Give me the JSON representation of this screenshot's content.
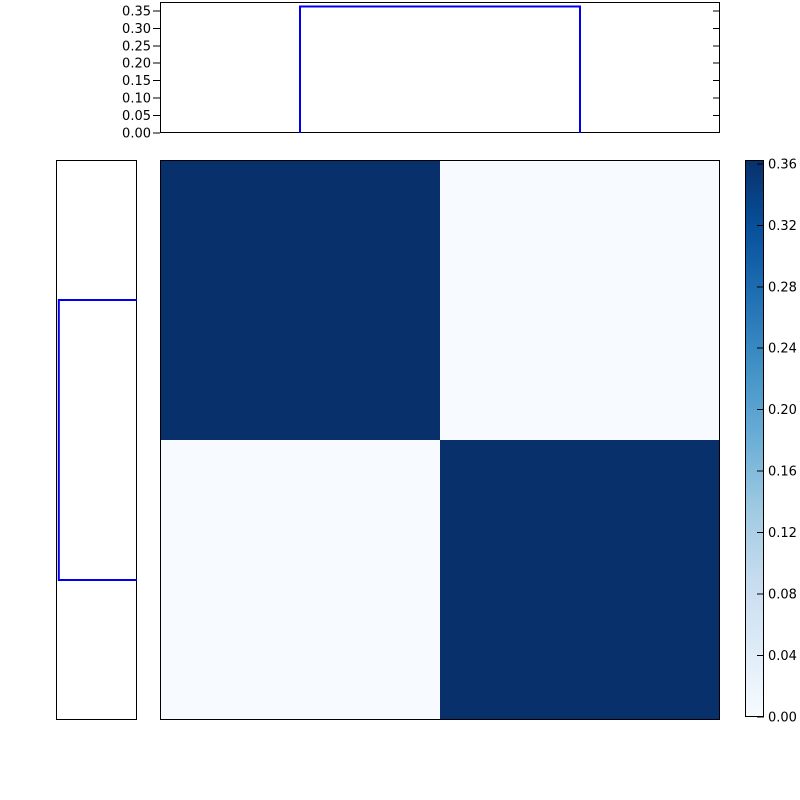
{
  "figure": {
    "background": "#ffffff",
    "frame_color": "#000000",
    "text_color": "#000000"
  },
  "colors": {
    "histogram_line": "#0000ee",
    "heat_high": "#08306b",
    "heat_low": "#f7fbff"
  },
  "chart_data": [
    {
      "id": "top-marginal-histogram",
      "type": "area",
      "description": "Top marginal distribution: rectangular step (top-hat) over the middle half of the x-range",
      "bar": {
        "start_frac": 0.25,
        "end_frac": 0.75,
        "value": 0.3625
      },
      "ylim": [
        0,
        0.3755
      ],
      "yticks": [
        0.35,
        0.3,
        0.25,
        0.2,
        0.15,
        0.1,
        0.05,
        0.0
      ],
      "ytick_labels": [
        "0.35",
        "0.30",
        "0.25",
        "0.20",
        "0.15",
        "0.10",
        "0.05",
        "0.00"
      ],
      "line_color": "#0000ee",
      "grid": false,
      "legend": null,
      "title": "",
      "xlabel": "",
      "ylabel": ""
    },
    {
      "id": "left-marginal-histogram",
      "type": "area",
      "description": "Left marginal distribution: rectangular step over the middle half of the y-range, value axis pointing left, no tick labels",
      "bar": {
        "start_frac": 0.25,
        "end_frac": 0.75,
        "value": 0.3625
      },
      "value_lim": [
        0,
        0.3755
      ],
      "ticks": "none",
      "line_color": "#0000ee"
    },
    {
      "id": "joint-heatmap",
      "type": "heatmap",
      "description": "2x2 joint distribution heatmap, dark diagonal, near-zero off-diagonal",
      "matrix": [
        [
          0.36,
          0.0
        ],
        [
          0.0,
          0.36
        ]
      ],
      "colormap": "Blues",
      "cell_colors": [
        [
          "#08306b",
          "#f7fbff"
        ],
        [
          "#f7fbff",
          "#08306b"
        ]
      ],
      "grid": false
    },
    {
      "id": "colorbar",
      "type": "colorbar",
      "orientation": "vertical",
      "vmin": 0.0,
      "vmax": 0.3625,
      "tick_values": [
        0.36,
        0.32,
        0.28,
        0.24,
        0.2,
        0.16,
        0.12,
        0.08,
        0.04,
        0.0
      ],
      "tick_labels": [
        "0.36",
        "0.32",
        "0.28",
        "0.24",
        "0.20",
        "0.16",
        "0.12",
        "0.08",
        "0.04",
        "0.00"
      ],
      "gradient_stops": [
        {
          "frac": 0.0,
          "color": "#f7fbff"
        },
        {
          "frac": 0.125,
          "color": "#deebf7"
        },
        {
          "frac": 0.25,
          "color": "#c6dbef"
        },
        {
          "frac": 0.375,
          "color": "#9ecae1"
        },
        {
          "frac": 0.5,
          "color": "#6baed6"
        },
        {
          "frac": 0.625,
          "color": "#4292c6"
        },
        {
          "frac": 0.75,
          "color": "#2171b5"
        },
        {
          "frac": 0.875,
          "color": "#08519c"
        },
        {
          "frac": 1.0,
          "color": "#08306b"
        }
      ]
    }
  ]
}
